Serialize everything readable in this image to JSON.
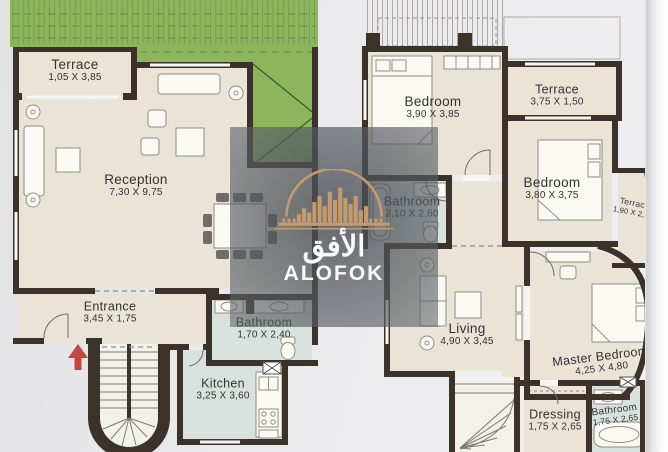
{
  "watermark": {
    "arabic": "الأفق",
    "latin": "ALOFOK"
  },
  "rooms": {
    "terrace_l": {
      "name": "Terrace",
      "dims": "1,05 X 3,85"
    },
    "reception": {
      "name": "Reception",
      "dims": "7,30 X 9,75"
    },
    "entrance": {
      "name": "Entrance",
      "dims": "3,45 X 1,75"
    },
    "bathroom_l": {
      "name": "Bathroom",
      "dims": "1,70 X 2,40"
    },
    "kitchen": {
      "name": "Kitchen",
      "dims": "3,25 X 3,60"
    },
    "bedroom_1": {
      "name": "Bedroom",
      "dims": "3,90 X 3,85"
    },
    "terrace_r1": {
      "name": "Terrace",
      "dims": "3,75 X 1,50"
    },
    "bedroom_2": {
      "name": "Bedroom",
      "dims": "3,80 X 3,75"
    },
    "terrace_r2": {
      "name": "Terrace",
      "dims": "1,90 X 2,15"
    },
    "bathroom_r1": {
      "name": "Bathroom",
      "dims": "2,10 X 2,60"
    },
    "living": {
      "name": "Living",
      "dims": "4,90 X 3,45"
    },
    "master_bedroom": {
      "name": "Master Bedroom",
      "dims": "4,25 X 4,80"
    },
    "dressing": {
      "name": "Dressing",
      "dims": "1,75 X 2,65"
    },
    "bathroom_r2": {
      "name": "Bathroom",
      "dims": "1,75 X 2,65"
    }
  },
  "colors": {
    "walls": "#3b332a",
    "floor": "#e9e4d6",
    "wet_rooms": "#d8e1de",
    "garden": "#8cb65c",
    "watermark_bg": "#565b62",
    "logo_accent": "#c49b6d",
    "entrance_arrow": "#c64540"
  }
}
